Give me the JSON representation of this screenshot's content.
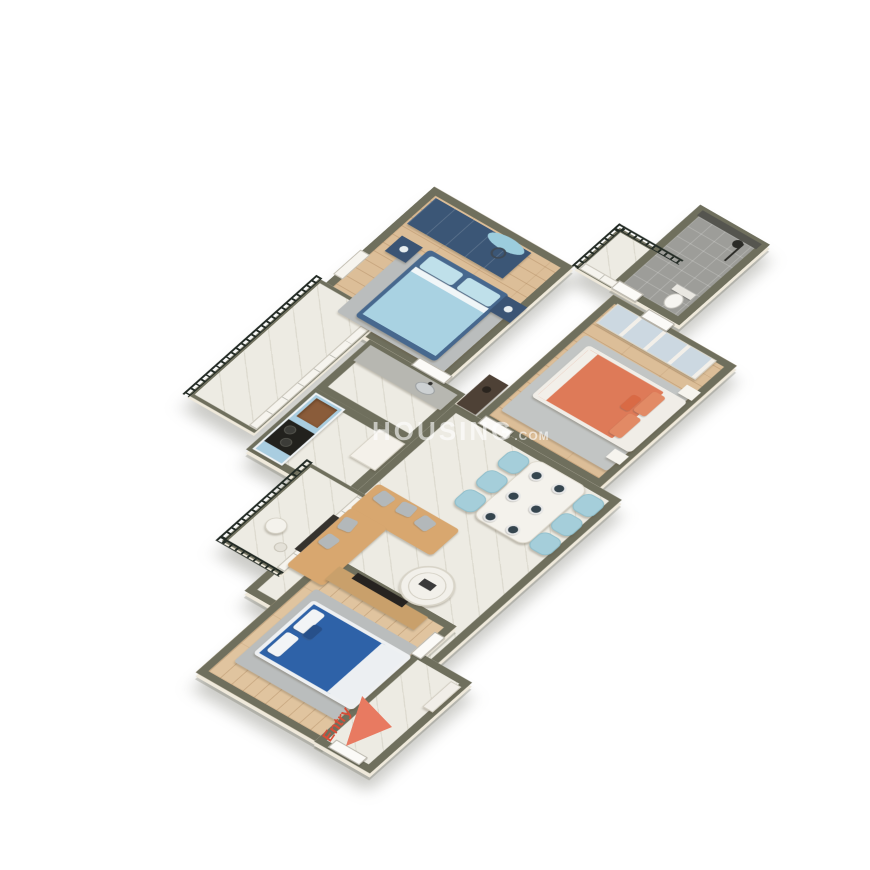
{
  "title": "3D Isometric Apartment Floor Plan",
  "watermark": {
    "brand": "HOUSING",
    "suffix": ".COM"
  },
  "entry": {
    "label": "Entry"
  },
  "palette": {
    "background": "#ffffff",
    "wall": "#6f6f5d",
    "wall_face": "#efe9db",
    "wood_floor": "#dcbe98",
    "marble_floor": "#edebe3",
    "bathroom_tile": "#9d9d99",
    "rug_gray": "#babdbd",
    "wardrobe_navy": "#3b5676",
    "bed_light_blue": "#a9d2e2",
    "bed_frame_blue": "#47688e",
    "bed_coral": "#de7a58",
    "bed_navy": "#2e62a8",
    "sofa_tan": "#d8a76f",
    "dining_chair_teal": "#a5ceda",
    "kitchen_cabinet_blue": "#a9cde0",
    "railing_black": "#222a24",
    "entry_red": "#d84e38",
    "entry_arrow": "#e87a61"
  },
  "rooms": [
    {
      "name": "master-bedroom",
      "floor": "wood",
      "furniture": [
        "navy-wardrobe",
        "double-bed-light-blue",
        "nightstand-left",
        "nightstand-right",
        "gray-rug",
        "wall-circle-decor",
        "balcony-door"
      ]
    },
    {
      "name": "bedroom-coral",
      "floor": "wood",
      "furniture": [
        "mirror-sliding-wardrobe",
        "double-bed-coral",
        "gray-rug",
        "side-table-1",
        "side-table-2",
        "ensuite-door"
      ]
    },
    {
      "name": "bedroom-navy",
      "floor": "wood",
      "furniture": [
        "tv-console",
        "wall-tv",
        "double-bed-navy",
        "gray-rug"
      ]
    },
    {
      "name": "bathroom",
      "floor": "tile",
      "furniture": [
        "shower",
        "toilet",
        "door"
      ]
    },
    {
      "name": "utility",
      "floor": "marble",
      "furniture": [
        "wash-counter",
        "steel-sink"
      ]
    },
    {
      "name": "kitchen",
      "floor": "marble",
      "furniture": [
        "blue-cabinet-run",
        "copper-sink",
        "hob-with-pans",
        "tall-unit"
      ]
    },
    {
      "name": "living-dining",
      "floor": "marble",
      "furniture": [
        "l-shaped-sofa",
        "sofa-pillows",
        "round-coffee-table",
        "dining-table",
        "six-chairs",
        "six-plates",
        "dresser"
      ]
    },
    {
      "name": "balcony-kitchen",
      "floor": "marble",
      "furniture": [
        "iron-railing",
        "sliding-windows"
      ]
    },
    {
      "name": "balcony-living",
      "floor": "marble",
      "furniture": [
        "iron-railing",
        "sliding-windows",
        "round-table",
        "stool"
      ]
    },
    {
      "name": "balcony-small",
      "floor": "marble",
      "furniture": [
        "iron-railing",
        "window"
      ]
    },
    {
      "name": "entry-foyer",
      "floor": "marble",
      "furniture": [
        "entry-door",
        "shoe-cabinet"
      ]
    }
  ]
}
